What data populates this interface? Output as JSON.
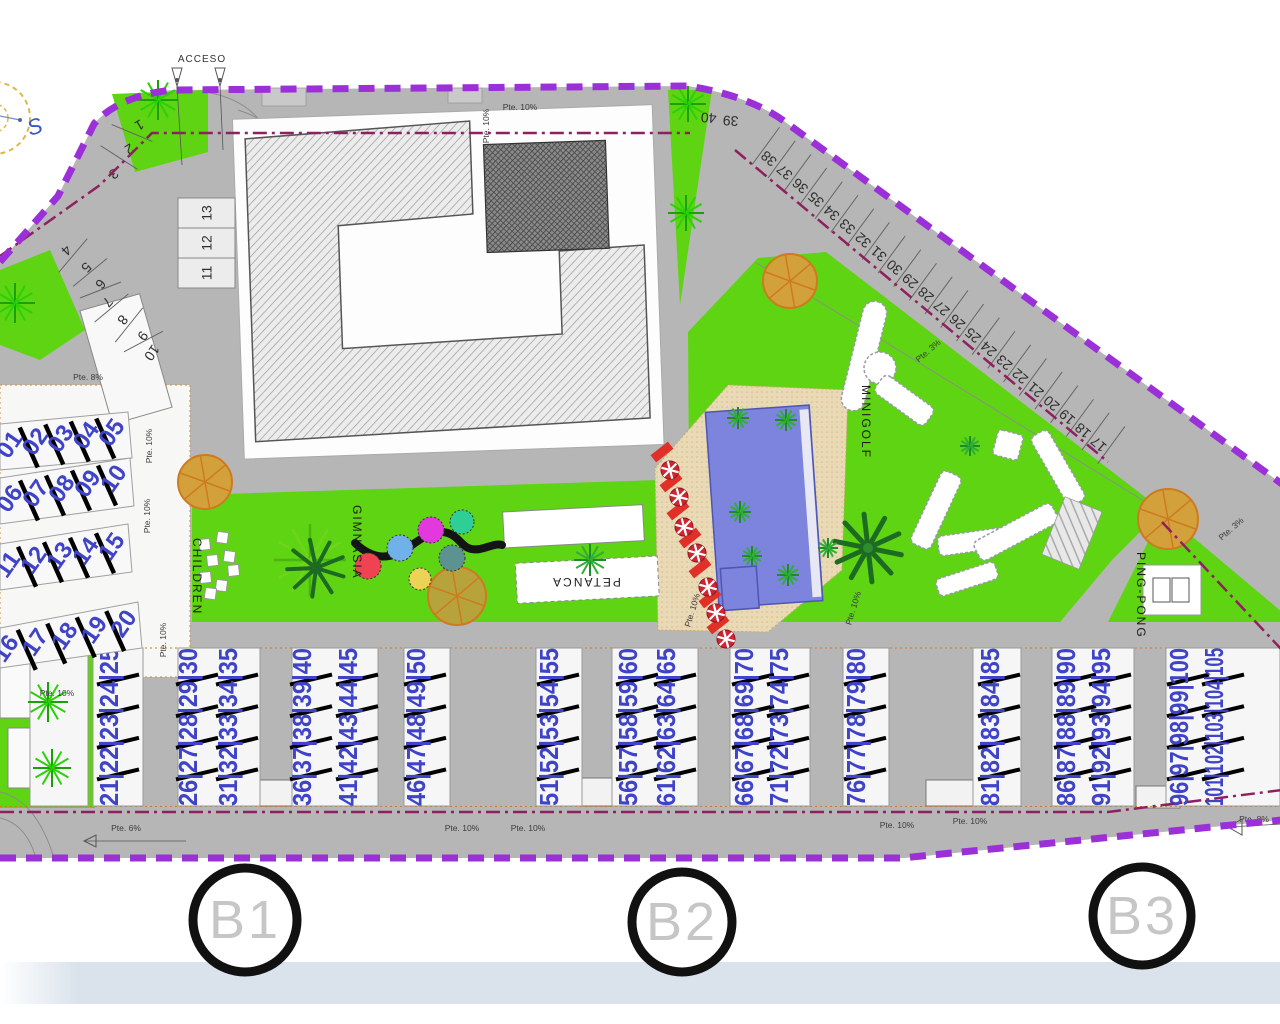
{
  "labels": {
    "acceso": "ACCESO",
    "children": "CHILDREN",
    "gimnasia": "GIMNASIA",
    "petanca": "PETANCA",
    "minigolf": "MINIGOLF",
    "pingpong": "PING-PONG",
    "compass_south": "S"
  },
  "block_markers": [
    {
      "label": "B1",
      "x": 245,
      "y": 920,
      "r": 52
    },
    {
      "label": "B2",
      "x": 682,
      "y": 922,
      "r": 50
    },
    {
      "label": "B3",
      "x": 1142,
      "y": 916,
      "r": 49
    }
  ],
  "parking": {
    "left_curve": [
      {
        "n": "1",
        "x": 137,
        "y": 121,
        "r": 150
      },
      {
        "n": "2",
        "x": 127,
        "y": 145,
        "r": 150
      },
      {
        "n": "3",
        "x": 111,
        "y": 170,
        "r": 145
      },
      {
        "n": "4",
        "x": 63,
        "y": 247,
        "r": 135
      },
      {
        "n": "5",
        "x": 83,
        "y": 264,
        "r": 135
      },
      {
        "n": "6",
        "x": 97,
        "y": 281,
        "r": 130
      },
      {
        "n": "7",
        "x": 104,
        "y": 299,
        "r": 130
      },
      {
        "n": "8",
        "x": 119,
        "y": 317,
        "r": 128
      },
      {
        "n": "9",
        "x": 139,
        "y": 333,
        "r": 126
      },
      {
        "n": "10",
        "x": 148,
        "y": 350,
        "r": 125
      }
    ],
    "stack": [
      "13",
      "12",
      "11"
    ],
    "top_pair": [
      {
        "n": "40",
        "x": 709,
        "y": 113,
        "r": 184
      },
      {
        "n": "39",
        "x": 731,
        "y": 116,
        "r": 184
      }
    ],
    "diagonal": {
      "numbers": [
        "38",
        "37",
        "36",
        "35",
        "34",
        "33",
        "32",
        "31",
        "30",
        "29",
        "28",
        "27",
        "26",
        "25",
        "24",
        "23",
        "22",
        "21",
        "20",
        "19",
        "18",
        "17"
      ],
      "x0": 772,
      "y0": 155,
      "dx": 15.7,
      "dy": 13.6,
      "rot": 221
    }
  },
  "units": {
    "left_rows": [
      {
        "labels": [
          "01",
          "02",
          "03",
          "04",
          "05"
        ],
        "x1": 16,
        "y1": 449,
        "x2": 118,
        "y2": 437,
        "poly": "0,424 128,412 132,458 0,470"
      },
      {
        "labels": [
          "06",
          "07",
          "08",
          "09",
          "10"
        ],
        "x1": 16,
        "y1": 503,
        "x2": 120,
        "y2": 483,
        "poly": "0,478 130,458 134,506 0,524"
      },
      {
        "labels": [
          "11",
          "12",
          "13",
          "14",
          "15"
        ],
        "x1": 14,
        "y1": 569,
        "x2": 118,
        "y2": 551,
        "poly": "0,544 128,524 132,572 0,590"
      },
      {
        "labels": [
          "16",
          "17",
          "18",
          "19",
          "20"
        ],
        "x1": 12,
        "y1": 653,
        "x2": 130,
        "y2": 628,
        "poly": "0,628 138,602 142,648 0,668"
      }
    ],
    "bottom_columns": [
      {
        "label": "21|22|23|24|25",
        "x": 118
      },
      {
        "label": "26|27|28|29|30",
        "x": 197
      },
      {
        "label": "31|32|33|34|35",
        "x": 237
      },
      {
        "label": "36|37|38|39|40",
        "x": 311
      },
      {
        "label": "41|42|43|44|45",
        "x": 357
      },
      {
        "label": "46|47|48|49|50",
        "x": 425
      },
      {
        "label": "51|52|53|54|55",
        "x": 558
      },
      {
        "label": "56|57|58|59|60",
        "x": 637
      },
      {
        "label": "61|62|63|64|65",
        "x": 675
      },
      {
        "label": "66|67|68|69|70",
        "x": 753
      },
      {
        "label": "71|72|73|74|75",
        "x": 788
      },
      {
        "label": "76|77|78|79|80",
        "x": 865
      },
      {
        "label": "81|82|83|84|85",
        "x": 999
      },
      {
        "label": "86|87|88|89|90",
        "x": 1075
      },
      {
        "label": "91|92|93|94|95",
        "x": 1110
      },
      {
        "label": "96|97|98|99|100",
        "x": 1188
      },
      {
        "label": "101|102|103|104|105",
        "x": 1223
      }
    ],
    "bottom_buildings": [
      {
        "x": 30,
        "w": 58
      },
      {
        "x": 93,
        "w": 50
      },
      {
        "x": 178,
        "w": 82
      },
      {
        "x": 292,
        "w": 86
      },
      {
        "x": 404,
        "w": 46
      },
      {
        "x": 536,
        "w": 46
      },
      {
        "x": 612,
        "w": 86
      },
      {
        "x": 730,
        "w": 80
      },
      {
        "x": 843,
        "w": 46
      },
      {
        "x": 973,
        "w": 48
      },
      {
        "x": 1052,
        "w": 82
      },
      {
        "x": 1166,
        "w": 114
      }
    ]
  },
  "slope_labels": [
    {
      "t": "Pte. 10%",
      "x": 520,
      "y": 110,
      "r": 0
    },
    {
      "t": "Pte. 10%",
      "x": 489,
      "y": 126,
      "r": -90
    },
    {
      "t": "Pte. 8%",
      "x": 88,
      "y": 380,
      "r": 0
    },
    {
      "t": "Pte. 10%",
      "x": 152,
      "y": 446,
      "r": -90
    },
    {
      "t": "Pte. 10%",
      "x": 150,
      "y": 516,
      "r": -90
    },
    {
      "t": "Pte. 10%",
      "x": 166,
      "y": 640,
      "r": -90
    },
    {
      "t": "Pte. 10%",
      "x": 57,
      "y": 696,
      "r": 0
    },
    {
      "t": "Pte. 6%",
      "x": 126,
      "y": 831,
      "r": 0
    },
    {
      "t": "Pte. 10%",
      "x": 462,
      "y": 831,
      "r": 0
    },
    {
      "t": "Pte. 10%",
      "x": 528,
      "y": 831,
      "r": 0
    },
    {
      "t": "Pte. 10%",
      "x": 897,
      "y": 828,
      "r": 0
    },
    {
      "t": "Pte. 10%",
      "x": 970,
      "y": 824,
      "r": 0
    },
    {
      "t": "Pte. 8%",
      "x": 1254,
      "y": 822,
      "r": 0
    },
    {
      "t": "Pte. 10%",
      "x": 695,
      "y": 611,
      "r": -73
    },
    {
      "t": "Pte. 10%",
      "x": 856,
      "y": 609,
      "r": -73
    },
    {
      "t": "Pte. 3%",
      "x": 930,
      "y": 353,
      "r": -41
    },
    {
      "t": "Pte. 3%",
      "x": 1233,
      "y": 531,
      "r": -41
    }
  ],
  "trees": [
    {
      "t": "burst",
      "x": 158,
      "y": 100,
      "r": 20
    },
    {
      "t": "burst",
      "x": 688,
      "y": 104,
      "r": 18
    },
    {
      "t": "burst",
      "x": 686,
      "y": 213,
      "r": 18
    },
    {
      "t": "burst",
      "x": 15,
      "y": 303,
      "r": 20
    },
    {
      "t": "burst",
      "x": 48,
      "y": 702,
      "r": 20
    },
    {
      "t": "burst",
      "x": 52,
      "y": 768,
      "r": 19
    },
    {
      "t": "orange",
      "x": 205,
      "y": 482,
      "r": 27
    },
    {
      "t": "orange",
      "x": 790,
      "y": 281,
      "r": 27
    },
    {
      "t": "orange",
      "x": 1168,
      "y": 519,
      "r": 30
    },
    {
      "t": "olive",
      "x": 457,
      "y": 596,
      "r": 29
    },
    {
      "t": "bigpalm",
      "x": 310,
      "y": 560,
      "r": 36
    },
    {
      "t": "darkpalm",
      "x": 868,
      "y": 548,
      "r": 34
    },
    {
      "t": "palm",
      "x": 590,
      "y": 560,
      "r": 16
    },
    {
      "t": "palm",
      "x": 738,
      "y": 418,
      "r": 11
    },
    {
      "t": "palm",
      "x": 786,
      "y": 420,
      "r": 11
    },
    {
      "t": "palm",
      "x": 740,
      "y": 512,
      "r": 11
    },
    {
      "t": "palm",
      "x": 752,
      "y": 556,
      "r": 10
    },
    {
      "t": "palm",
      "x": 788,
      "y": 575,
      "r": 11
    },
    {
      "t": "palm",
      "x": 828,
      "y": 548,
      "r": 10
    },
    {
      "t": "palm",
      "x": 970,
      "y": 446,
      "r": 10
    }
  ],
  "play_circles": [
    {
      "c": "#ef4352",
      "x": 368,
      "y": 566,
      "r": 13
    },
    {
      "c": "#6fb1e8",
      "x": 400,
      "y": 548,
      "r": 13
    },
    {
      "c": "#e238dd",
      "x": 431,
      "y": 530,
      "r": 13
    },
    {
      "c": "#2ecf96",
      "x": 462,
      "y": 522,
      "r": 12
    },
    {
      "c": "#5c9391",
      "x": 452,
      "y": 558,
      "r": 13
    },
    {
      "c": "#ecd355",
      "x": 420,
      "y": 579,
      "r": 11
    }
  ],
  "children_squares": [
    {
      "x": 204,
      "y": 544
    },
    {
      "x": 222,
      "y": 537
    },
    {
      "x": 212,
      "y": 560
    },
    {
      "x": 229,
      "y": 556
    },
    {
      "x": 205,
      "y": 577
    },
    {
      "x": 221,
      "y": 585
    },
    {
      "x": 233,
      "y": 570
    },
    {
      "x": 210,
      "y": 593
    }
  ],
  "pool_items": {
    "umbrellas": [
      {
        "x": 670,
        "y": 470
      },
      {
        "x": 679,
        "y": 497
      },
      {
        "x": 684,
        "y": 527
      },
      {
        "x": 697,
        "y": 553
      },
      {
        "x": 708,
        "y": 587
      },
      {
        "x": 716,
        "y": 613
      },
      {
        "x": 726,
        "y": 639
      }
    ],
    "loungers": [
      {
        "x": 662,
        "y": 452
      },
      {
        "x": 671,
        "y": 482
      },
      {
        "x": 678,
        "y": 510
      },
      {
        "x": 690,
        "y": 538
      },
      {
        "x": 700,
        "y": 568
      },
      {
        "x": 710,
        "y": 598
      },
      {
        "x": 718,
        "y": 624
      }
    ]
  },
  "colors": {
    "boundary": "#9b2fd8",
    "setback": "#8e2060",
    "road": "#b6b6b6",
    "green": "#5ed412",
    "pool": "#7d84dd",
    "deck": "#ead9b5",
    "unit_number": "#3f43c8",
    "band": "#dae3ec"
  }
}
